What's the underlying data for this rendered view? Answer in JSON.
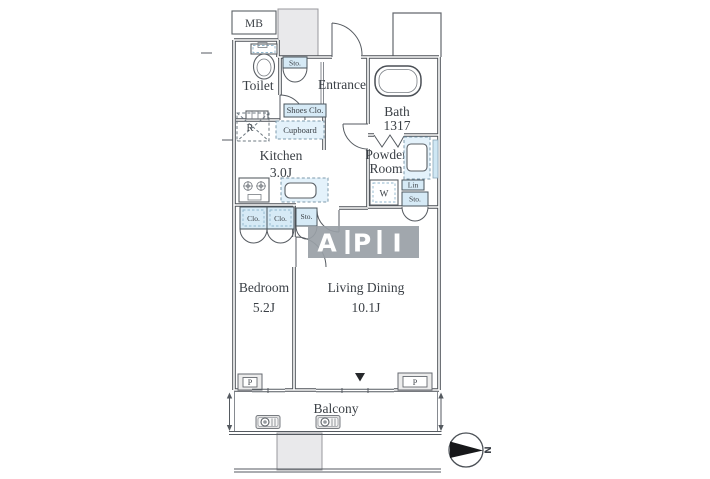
{
  "labels": {
    "mb": "MB",
    "toilet": "Toilet",
    "entrance": "Entrance",
    "kitchen": "Kitchen",
    "kitchen_size": "3.0J",
    "bath": "Bath",
    "bath_size": "1317",
    "powder_line1": "Powder",
    "powder_line2": "Room",
    "bedroom": "Bedroom",
    "bedroom_size": "5.2J",
    "living": "Living Dining",
    "living_size": "10.1J",
    "balcony": "Balcony",
    "sto_entrance": "Sto.",
    "shoes_closet": "Shoes Clo.",
    "cupboard": "Cupboard",
    "fridge": "R",
    "closet_left": "Clo.",
    "closet_right": "Clo.",
    "sto_hall": "Sto.",
    "washer": "W",
    "linen": "Lin",
    "sto_powder": "Sto.",
    "pillar_left": "P",
    "pillar_right": "P",
    "compass_north": "N"
  },
  "watermark": {
    "letters": [
      "A",
      "P",
      "I"
    ],
    "background": "#99a0a6",
    "text_color": "#ffffff"
  },
  "colors": {
    "wall_line": "#4a4f55",
    "storage_fill": "#d6eaf6",
    "shaft_fill": "#e9e9eb"
  }
}
